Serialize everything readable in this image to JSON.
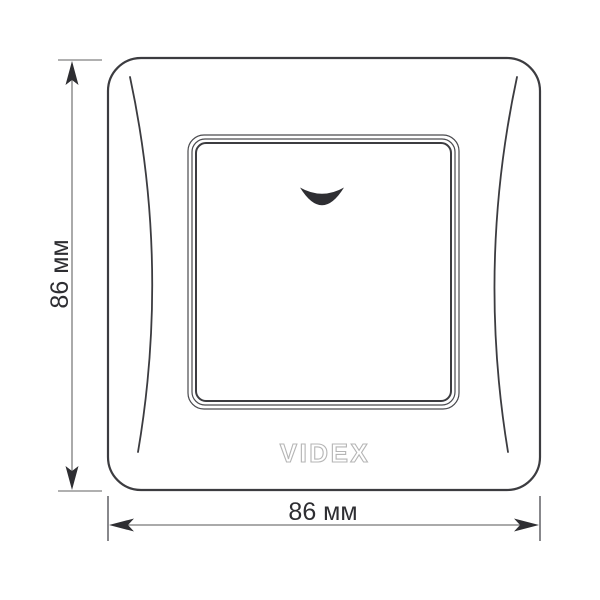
{
  "drawing": {
    "type": "product-dimension-diagram",
    "product": "single-key wall switch with backlight indicator, front view",
    "brand": "VIDEX",
    "logo_text": "VIDEX",
    "dimensions": {
      "height": {
        "label": "86 мм",
        "value": 86,
        "unit": "мм"
      },
      "width": {
        "label": "86 мм",
        "value": 86,
        "unit": "мм"
      }
    },
    "icons": {
      "switch_indicator": "crescent-smile-indicator"
    },
    "colors": {
      "background": "#ffffff",
      "plate_outline": "#3c3c40",
      "thin_frame_line": "#4a4a4e",
      "dimension_line": "#8e8e8e",
      "tick_line": "#a5a5a5",
      "extension_line": "#55555a",
      "arrowhead": "#2e2e32",
      "text": "#2e2e32",
      "logo_outline": "#b5b5b5",
      "indicator_fill": "#2e2e32"
    }
  }
}
